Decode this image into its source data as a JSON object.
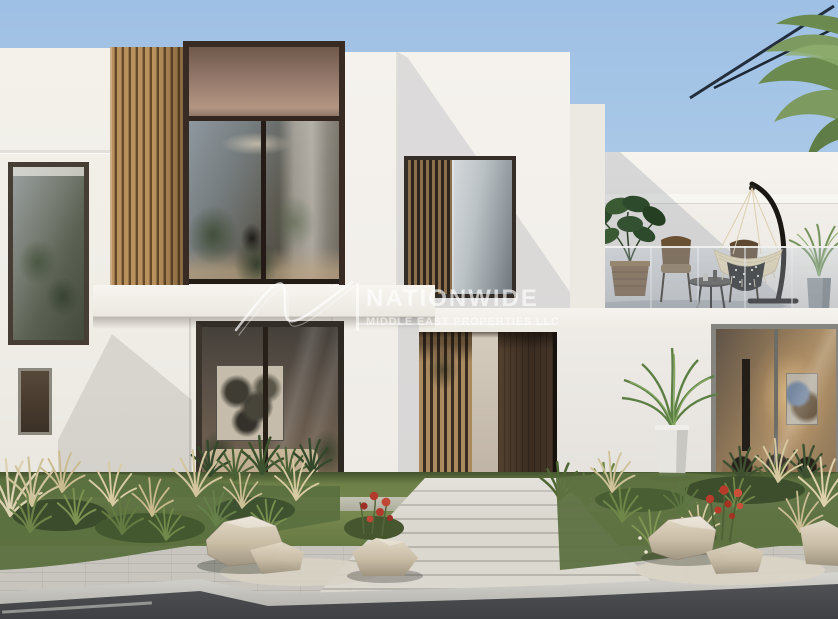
{
  "watermark": {
    "brand": "NATIONWIDE",
    "tagline": "MIDDLE EAST PROPERTIES LLC",
    "logo": "swoosh-monogram",
    "color": "#ffffff",
    "opacity": 0.62
  },
  "scene": {
    "type": "architectural-exterior-render",
    "subject": "Modern two-storey white villa with wood-slat accents, roof terrace with hanging egg chair, landscaped front garden, stone walkway, sidewalk and asphalt street in the foreground, palm tree at top right under a clear blue sky",
    "sky": {
      "top": "#9ec0e4",
      "horizon": "#d8e5f3"
    },
    "palette": {
      "facade_white": "#f2efe9",
      "facade_shadow": "#b9bec9",
      "wood_slats": "#a9814f",
      "window_frame_dark": "#382b24",
      "window_frame_gray": "#85847f",
      "glass_warm": "#8a7058",
      "glass_cool": "#9aa4ab",
      "door": "#43342a",
      "grass": "#6d8048",
      "gravel": "#d8d2c4",
      "rock": "#cbbfa9",
      "flowers_red": "#b43a2c",
      "palm_green": "#7d9b60",
      "asphalt": "#45474a",
      "curb": "#c9c8c3",
      "pavers": "#cfccc4",
      "hanging_chair_seat": "#e8d9b4",
      "hanging_chair_stand": "#191613"
    },
    "elements": [
      "sky",
      "palm-tree",
      "roof-terrace",
      "hanging-egg-chair",
      "monstera-plant",
      "outdoor-chairs",
      "side-table",
      "glass-balustrade",
      "wood-slat-panel",
      "upper-window-left",
      "upper-window-center",
      "entry-door",
      "entry-slat-screen",
      "potted-palm",
      "ground-window-artwork",
      "ground-window-dining",
      "front-lawn",
      "ornamental-grasses",
      "red-flowers",
      "rocks",
      "gravel-beds",
      "stone-walkway",
      "sidewalk",
      "curb",
      "asphalt-road"
    ]
  }
}
